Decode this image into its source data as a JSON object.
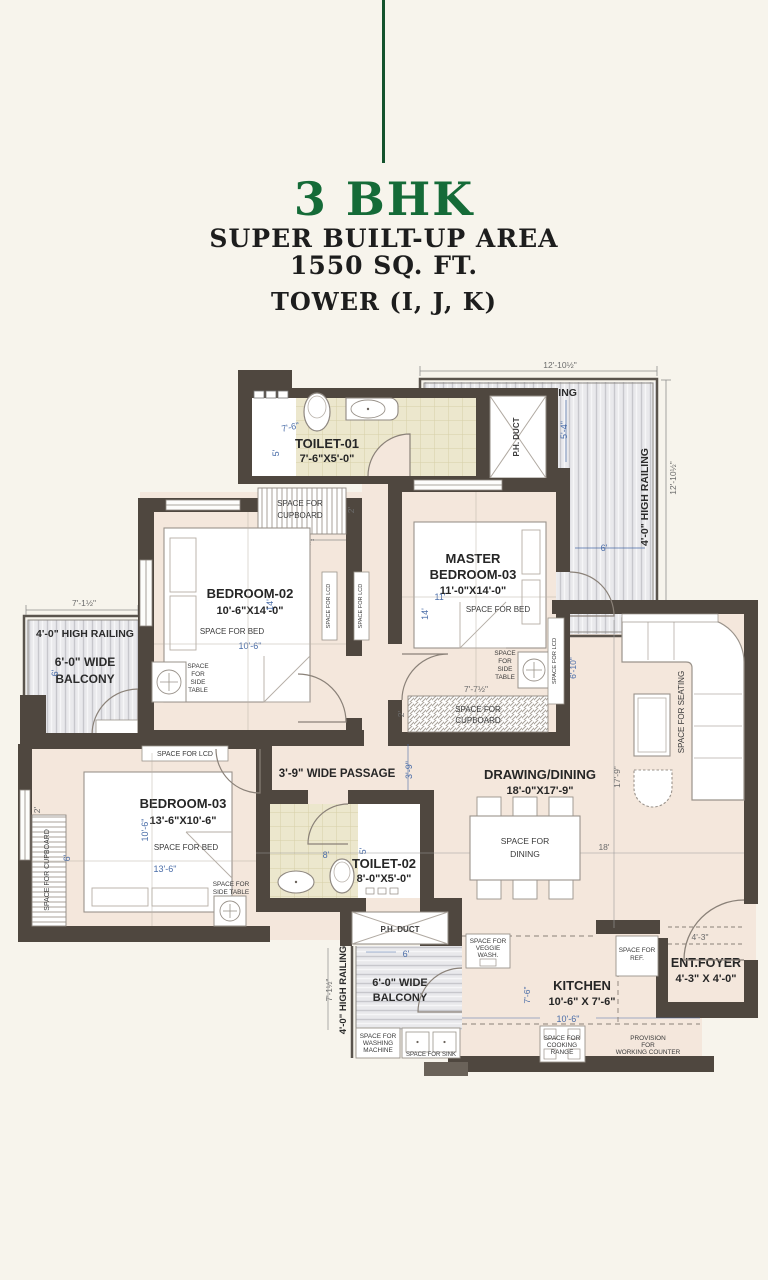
{
  "header": {
    "title": "3 BHK",
    "line1": "SUPER BUILT-UP AREA",
    "line2": "1550 SQ. FT.",
    "line3": "TOWER (I, J, K)"
  },
  "colors": {
    "accent_green": "#156b38",
    "wall": "#4f473f",
    "floor": "#f4e7dc",
    "dim_blue": "#4a6da8"
  },
  "rooms": {
    "toilet1_name": "TOILET-01",
    "toilet1_size": "7'-6\"X5'-0\"",
    "toilet2_name": "TOILET-02",
    "toilet2_size": "8'-0\"X5'-0\"",
    "bedroom2_name": "BEDROOM-02",
    "bedroom2_size": "10'-6\"X14'-0\"",
    "master_l1": "MASTER",
    "master_l2": "BEDROOM-03",
    "master_size": "11'-0\"X14'-0\"",
    "bedroom3_name": "BEDROOM-03",
    "bedroom3_size": "13'-6\"X10'-6\"",
    "drawing_name": "DRAWING/DINING",
    "drawing_size": "18'-0\"X17'-9\"",
    "kitchen_name": "KITCHEN",
    "kitchen_size": "10'-6\" X 7'-6\"",
    "foyer_name": "ENT.FOYER",
    "foyer_size": "4'-3\" X 4'-0\"",
    "passage": "3'-9\" WIDE PASSAGE"
  },
  "balconies": {
    "railing": "4'-0\" HIGH RAILING",
    "top_l1": "5'-4½\" WIDE",
    "top_l2": "BALCONY",
    "left_l1": "6'-0\" WIDE",
    "left_l2": "BALCONY",
    "bottom_l1": "6'-0\" WIDE",
    "bottom_l2": "BALCONY"
  },
  "annotations": {
    "ph_duct": "P.H. DUCT",
    "bed": "SPACE FOR BED",
    "cupboard_l1": "SPACE FOR",
    "cupboard_l2": "CUPBOARD",
    "cupboard_vert": "SPACE FOR CUPBOARD",
    "lcd": "SPACE FOR LCD",
    "side_table": [
      "SPACE",
      "FOR",
      "SIDE",
      "TABLE"
    ],
    "side_table_2l": [
      "SPACE FOR",
      "SIDE TABLE"
    ],
    "seating": "SPACE FOR SEATING",
    "dining_l1": "SPACE FOR",
    "dining_l2": "DINING",
    "ref": [
      "SPACE FOR",
      "REF."
    ],
    "veggie": [
      "SPACE FOR",
      "VEGGIE",
      "WASH."
    ],
    "washing": [
      "SPACE FOR",
      "WASHING",
      "MACHINE"
    ],
    "sink": "SPACE FOR SINK",
    "cooking": [
      "SPACE FOR",
      "COOKING",
      "RANGE"
    ],
    "counter": [
      "PROVISION",
      "FOR",
      "WORKING COUNTER"
    ]
  },
  "dims": {
    "d12_10": "12'-10½\"",
    "d5_4": "5'-4\"",
    "d6": "6'",
    "d7_1": "7'-1½\"",
    "d4_7": "4'-7½\"",
    "d2": "2'",
    "d14": "14'",
    "d10_6": "10'-6\"",
    "d11": "11'",
    "d6_10": "6'-10\"",
    "d7_7": "7'-7½\"",
    "d17_9": "17'-9\"",
    "d18": "18'",
    "d3_9": "3'-9\"",
    "d8": "8'",
    "d5": "5'",
    "d7_6": "7'-6\"",
    "d13_6": "13'-6\"",
    "d4_3": "4'-3\""
  }
}
